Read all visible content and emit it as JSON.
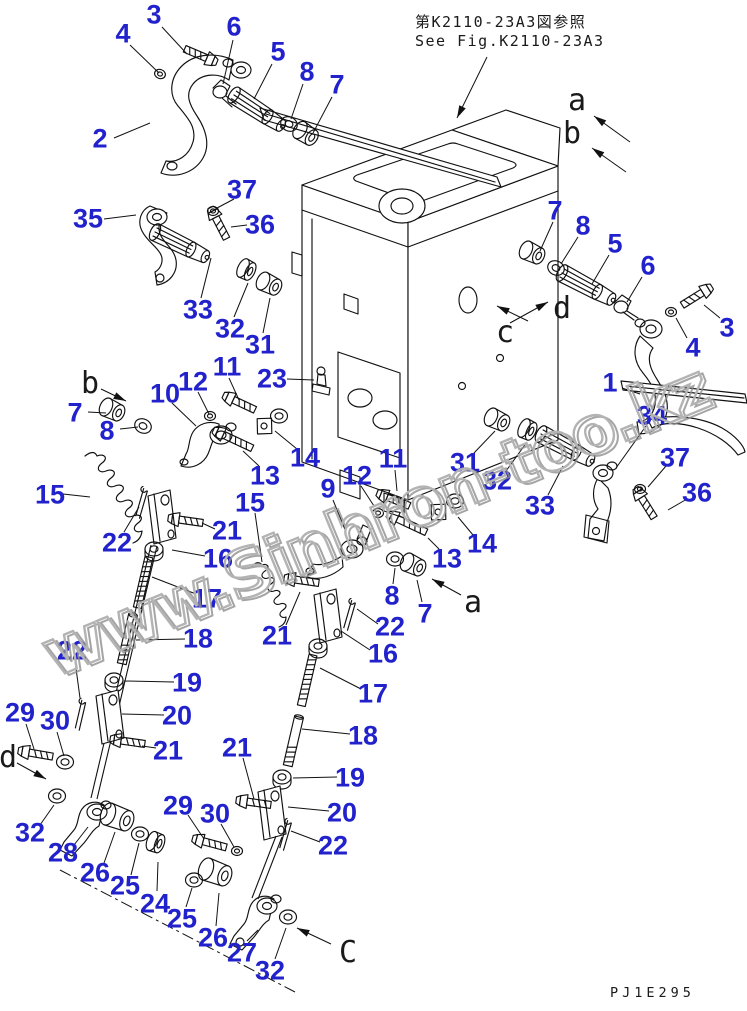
{
  "note": {
    "jp": "第K2110-23A3図参照",
    "en": "See Fig.K2110-23A3",
    "arrow": [
      487,
      57,
      457,
      118
    ]
  },
  "drawing_code": "PJ1E295",
  "watermark": "www.Sinhron-too.kz",
  "colors": {
    "callout": "#2222cc",
    "line": "#111111",
    "watermark": "#b3b3b3"
  },
  "callouts": [
    {
      "t": "3",
      "x": 154,
      "y": 14,
      "l": [
        162,
        27,
        187,
        54
      ]
    },
    {
      "t": "4",
      "x": 123,
      "y": 33,
      "l": [
        130,
        45,
        159,
        73
      ]
    },
    {
      "t": "6",
      "x": 234,
      "y": 26,
      "l": [
        233,
        40,
        223,
        84
      ]
    },
    {
      "t": "5",
      "x": 278,
      "y": 51,
      "l": [
        272,
        64,
        254,
        99
      ]
    },
    {
      "t": "8",
      "x": 307,
      "y": 71,
      "l": [
        303,
        84,
        291,
        119
      ]
    },
    {
      "t": "7",
      "x": 337,
      "y": 84,
      "l": [
        332,
        97,
        313,
        133
      ]
    },
    {
      "t": "2",
      "x": 100,
      "y": 138,
      "l": [
        114,
        138,
        150,
        123
      ]
    },
    {
      "t": "37",
      "x": 242,
      "y": 189,
      "l": [
        234,
        199,
        217,
        208
      ]
    },
    {
      "t": "35",
      "x": 88,
      "y": 218,
      "l": [
        104,
        219,
        136,
        215
      ]
    },
    {
      "t": "36",
      "x": 260,
      "y": 224,
      "l": [
        247,
        225,
        231,
        227
      ]
    },
    {
      "t": "33",
      "x": 198,
      "y": 309,
      "l": [
        201,
        298,
        211,
        258
      ]
    },
    {
      "t": "32",
      "x": 230,
      "y": 328,
      "l": [
        234,
        317,
        248,
        283
      ]
    },
    {
      "t": "31",
      "x": 260,
      "y": 344,
      "l": [
        263,
        333,
        270,
        298
      ]
    },
    {
      "t": "7",
      "x": 75,
      "y": 412,
      "l": [
        88,
        412,
        106,
        413
      ]
    },
    {
      "t": "8",
      "x": 107,
      "y": 430,
      "l": [
        120,
        429,
        138,
        427
      ]
    },
    {
      "t": "10",
      "x": 165,
      "y": 393,
      "l": [
        172,
        403,
        196,
        426
      ]
    },
    {
      "t": "12",
      "x": 193,
      "y": 381,
      "l": [
        198,
        392,
        209,
        414
      ]
    },
    {
      "t": "11",
      "x": 227,
      "y": 366,
      "l": [
        229,
        378,
        239,
        400
      ]
    },
    {
      "t": "23",
      "x": 272,
      "y": 378,
      "l": [
        287,
        379,
        314,
        380
      ]
    },
    {
      "t": "13",
      "x": 265,
      "y": 475,
      "l": [
        259,
        466,
        243,
        451
      ]
    },
    {
      "t": "14",
      "x": 305,
      "y": 457,
      "l": [
        297,
        449,
        275,
        431
      ]
    },
    {
      "t": "15",
      "x": 50,
      "y": 494,
      "l": [
        63,
        494,
        90,
        497
      ]
    },
    {
      "t": "22",
      "x": 117,
      "y": 542,
      "l": [
        124,
        532,
        139,
        507
      ]
    },
    {
      "t": "21",
      "x": 227,
      "y": 530,
      "l": [
        215,
        529,
        202,
        523
      ]
    },
    {
      "t": "16",
      "x": 218,
      "y": 558,
      "l": [
        205,
        556,
        172,
        550
      ]
    },
    {
      "t": "17",
      "x": 207,
      "y": 598,
      "l": [
        196,
        594,
        152,
        577
      ]
    },
    {
      "t": "18",
      "x": 198,
      "y": 638,
      "l": [
        185,
        639,
        136,
        640
      ]
    },
    {
      "t": "19",
      "x": 187,
      "y": 682,
      "l": [
        174,
        682,
        124,
        681
      ]
    },
    {
      "t": "20",
      "x": 177,
      "y": 715,
      "l": [
        164,
        715,
        122,
        714
      ]
    },
    {
      "t": "21",
      "x": 168,
      "y": 750,
      "l": [
        156,
        748,
        142,
        746
      ]
    },
    {
      "t": "22",
      "x": 72,
      "y": 650,
      "l": [
        75,
        661,
        80,
        698
      ]
    },
    {
      "t": "29",
      "x": 20,
      "y": 712,
      "l": [
        26,
        724,
        34,
        749
      ]
    },
    {
      "t": "30",
      "x": 55,
      "y": 720,
      "l": [
        57,
        732,
        64,
        756
      ]
    },
    {
      "t": "32",
      "x": 30,
      "y": 832,
      "l": [
        40,
        825,
        54,
        805
      ]
    },
    {
      "t": "28",
      "x": 63,
      "y": 852,
      "l": [
        74,
        845,
        88,
        827
      ]
    },
    {
      "t": "26",
      "x": 95,
      "y": 872,
      "l": [
        104,
        863,
        115,
        832
      ]
    },
    {
      "t": "25",
      "x": 125,
      "y": 885,
      "l": [
        131,
        875,
        139,
        843
      ]
    },
    {
      "t": "24",
      "x": 155,
      "y": 903,
      "l": [
        157,
        891,
        158,
        862
      ]
    },
    {
      "t": "25",
      "x": 182,
      "y": 918,
      "l": [
        186,
        907,
        192,
        888
      ]
    },
    {
      "t": "26",
      "x": 213,
      "y": 937,
      "l": [
        216,
        926,
        219,
        893
      ]
    },
    {
      "t": "27",
      "x": 242,
      "y": 952,
      "l": [
        247,
        941,
        258,
        930
      ]
    },
    {
      "t": "32",
      "x": 270,
      "y": 970,
      "l": [
        275,
        959,
        286,
        928
      ]
    },
    {
      "t": "29",
      "x": 178,
      "y": 805,
      "l": [
        188,
        815,
        204,
        839
      ]
    },
    {
      "t": "30",
      "x": 215,
      "y": 813,
      "l": [
        221,
        824,
        234,
        847
      ]
    },
    {
      "t": "21",
      "x": 277,
      "y": 635,
      "l": [
        286,
        625,
        300,
        592
      ]
    },
    {
      "t": "22",
      "x": 390,
      "y": 626,
      "l": [
        378,
        624,
        357,
        609
      ]
    },
    {
      "t": "16",
      "x": 383,
      "y": 653,
      "l": [
        370,
        650,
        341,
        631
      ]
    },
    {
      "t": "17",
      "x": 373,
      "y": 693,
      "l": [
        361,
        689,
        320,
        668
      ]
    },
    {
      "t": "18",
      "x": 363,
      "y": 735,
      "l": [
        350,
        734,
        302,
        729
      ]
    },
    {
      "t": "19",
      "x": 350,
      "y": 777,
      "l": [
        337,
        777,
        293,
        778
      ]
    },
    {
      "t": "20",
      "x": 342,
      "y": 812,
      "l": [
        329,
        811,
        288,
        807
      ]
    },
    {
      "t": "22",
      "x": 333,
      "y": 845,
      "l": [
        320,
        842,
        291,
        831
      ]
    },
    {
      "t": "21",
      "x": 237,
      "y": 747,
      "l": [
        243,
        758,
        254,
        799
      ]
    },
    {
      "t": "15",
      "x": 250,
      "y": 502,
      "l": [
        255,
        513,
        262,
        562
      ]
    },
    {
      "t": "9",
      "x": 328,
      "y": 488,
      "l": [
        333,
        500,
        346,
        532
      ]
    },
    {
      "t": "12",
      "x": 357,
      "y": 475,
      "l": [
        361,
        486,
        374,
        506
      ]
    },
    {
      "t": "11",
      "x": 393,
      "y": 458,
      "l": [
        395,
        470,
        397,
        491
      ]
    },
    {
      "t": "14",
      "x": 482,
      "y": 543,
      "l": [
        473,
        535,
        458,
        517
      ]
    },
    {
      "t": "13",
      "x": 447,
      "y": 558,
      "l": [
        439,
        549,
        428,
        538
      ]
    },
    {
      "t": "8",
      "x": 392,
      "y": 595,
      "l": [
        393,
        584,
        395,
        568
      ]
    },
    {
      "t": "7",
      "x": 425,
      "y": 613,
      "l": [
        422,
        602,
        417,
        580
      ]
    },
    {
      "t": "31",
      "x": 465,
      "y": 462,
      "l": [
        474,
        453,
        495,
        431
      ]
    },
    {
      "t": "32",
      "x": 497,
      "y": 480,
      "l": [
        506,
        471,
        527,
        442
      ]
    },
    {
      "t": "33",
      "x": 540,
      "y": 505,
      "l": [
        548,
        495,
        563,
        466
      ]
    },
    {
      "t": "7",
      "x": 555,
      "y": 210,
      "l": [
        553,
        222,
        540,
        251
      ]
    },
    {
      "t": "8",
      "x": 583,
      "y": 225,
      "l": [
        578,
        237,
        561,
        264
      ]
    },
    {
      "t": "5",
      "x": 615,
      "y": 243,
      "l": [
        609,
        255,
        592,
        284
      ]
    },
    {
      "t": "6",
      "x": 648,
      "y": 265,
      "l": [
        642,
        277,
        627,
        302
      ]
    },
    {
      "t": "3",
      "x": 727,
      "y": 327,
      "l": [
        720,
        318,
        704,
        305
      ]
    },
    {
      "t": "4",
      "x": 693,
      "y": 347,
      "l": [
        687,
        338,
        676,
        318
      ]
    },
    {
      "t": "1",
      "x": 610,
      "y": 382,
      "l": [
        622,
        388,
        640,
        394
      ]
    },
    {
      "t": "34",
      "x": 652,
      "y": 415,
      "l": [
        646,
        426,
        616,
        468
      ]
    },
    {
      "t": "37",
      "x": 675,
      "y": 457,
      "l": [
        666,
        466,
        648,
        487
      ]
    },
    {
      "t": "36",
      "x": 697,
      "y": 492,
      "l": [
        687,
        499,
        668,
        510
      ]
    }
  ],
  "view_letters": [
    {
      "t": "a",
      "x": 577,
      "y": 100,
      "arrow": [
        630,
        142,
        594,
        116
      ]
    },
    {
      "t": "b",
      "x": 572,
      "y": 133,
      "arrow": [
        626,
        172,
        592,
        148
      ]
    },
    {
      "t": "d",
      "x": 562,
      "y": 308,
      "arrow": [
        510,
        323,
        548,
        302
      ]
    },
    {
      "t": "c",
      "x": 505,
      "y": 332,
      "arrow": [
        528,
        321,
        497,
        306
      ]
    },
    {
      "t": "b",
      "x": 90,
      "y": 383,
      "arrow": [
        101,
        389,
        126,
        401
      ]
    },
    {
      "t": "a",
      "x": 473,
      "y": 602,
      "arrow": [
        461,
        595,
        432,
        579
      ]
    },
    {
      "t": "d",
      "x": 8,
      "y": 757,
      "arrow": [
        17,
        763,
        46,
        779
      ]
    },
    {
      "t": "C",
      "x": 348,
      "y": 952,
      "arrow": [
        331,
        944,
        297,
        928
      ]
    }
  ]
}
